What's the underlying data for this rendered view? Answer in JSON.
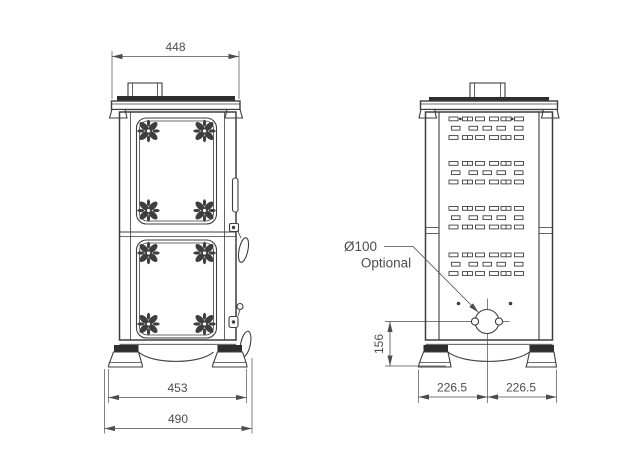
{
  "drawing": {
    "colors": {
      "line": "#3e3e3e",
      "dim": "#4d4d4d",
      "dark": "#2e2e2e",
      "background": "#ffffff"
    },
    "front_view": {
      "dimensions": {
        "top_width": "448",
        "feet_width": "453",
        "overall_width": "490"
      }
    },
    "rear_view": {
      "dimensions": {
        "outlet_height": "156",
        "left_half": "226.5",
        "right_half": "226.5"
      },
      "annotation": {
        "diameter": "Ø100",
        "note": "Optional"
      }
    }
  }
}
